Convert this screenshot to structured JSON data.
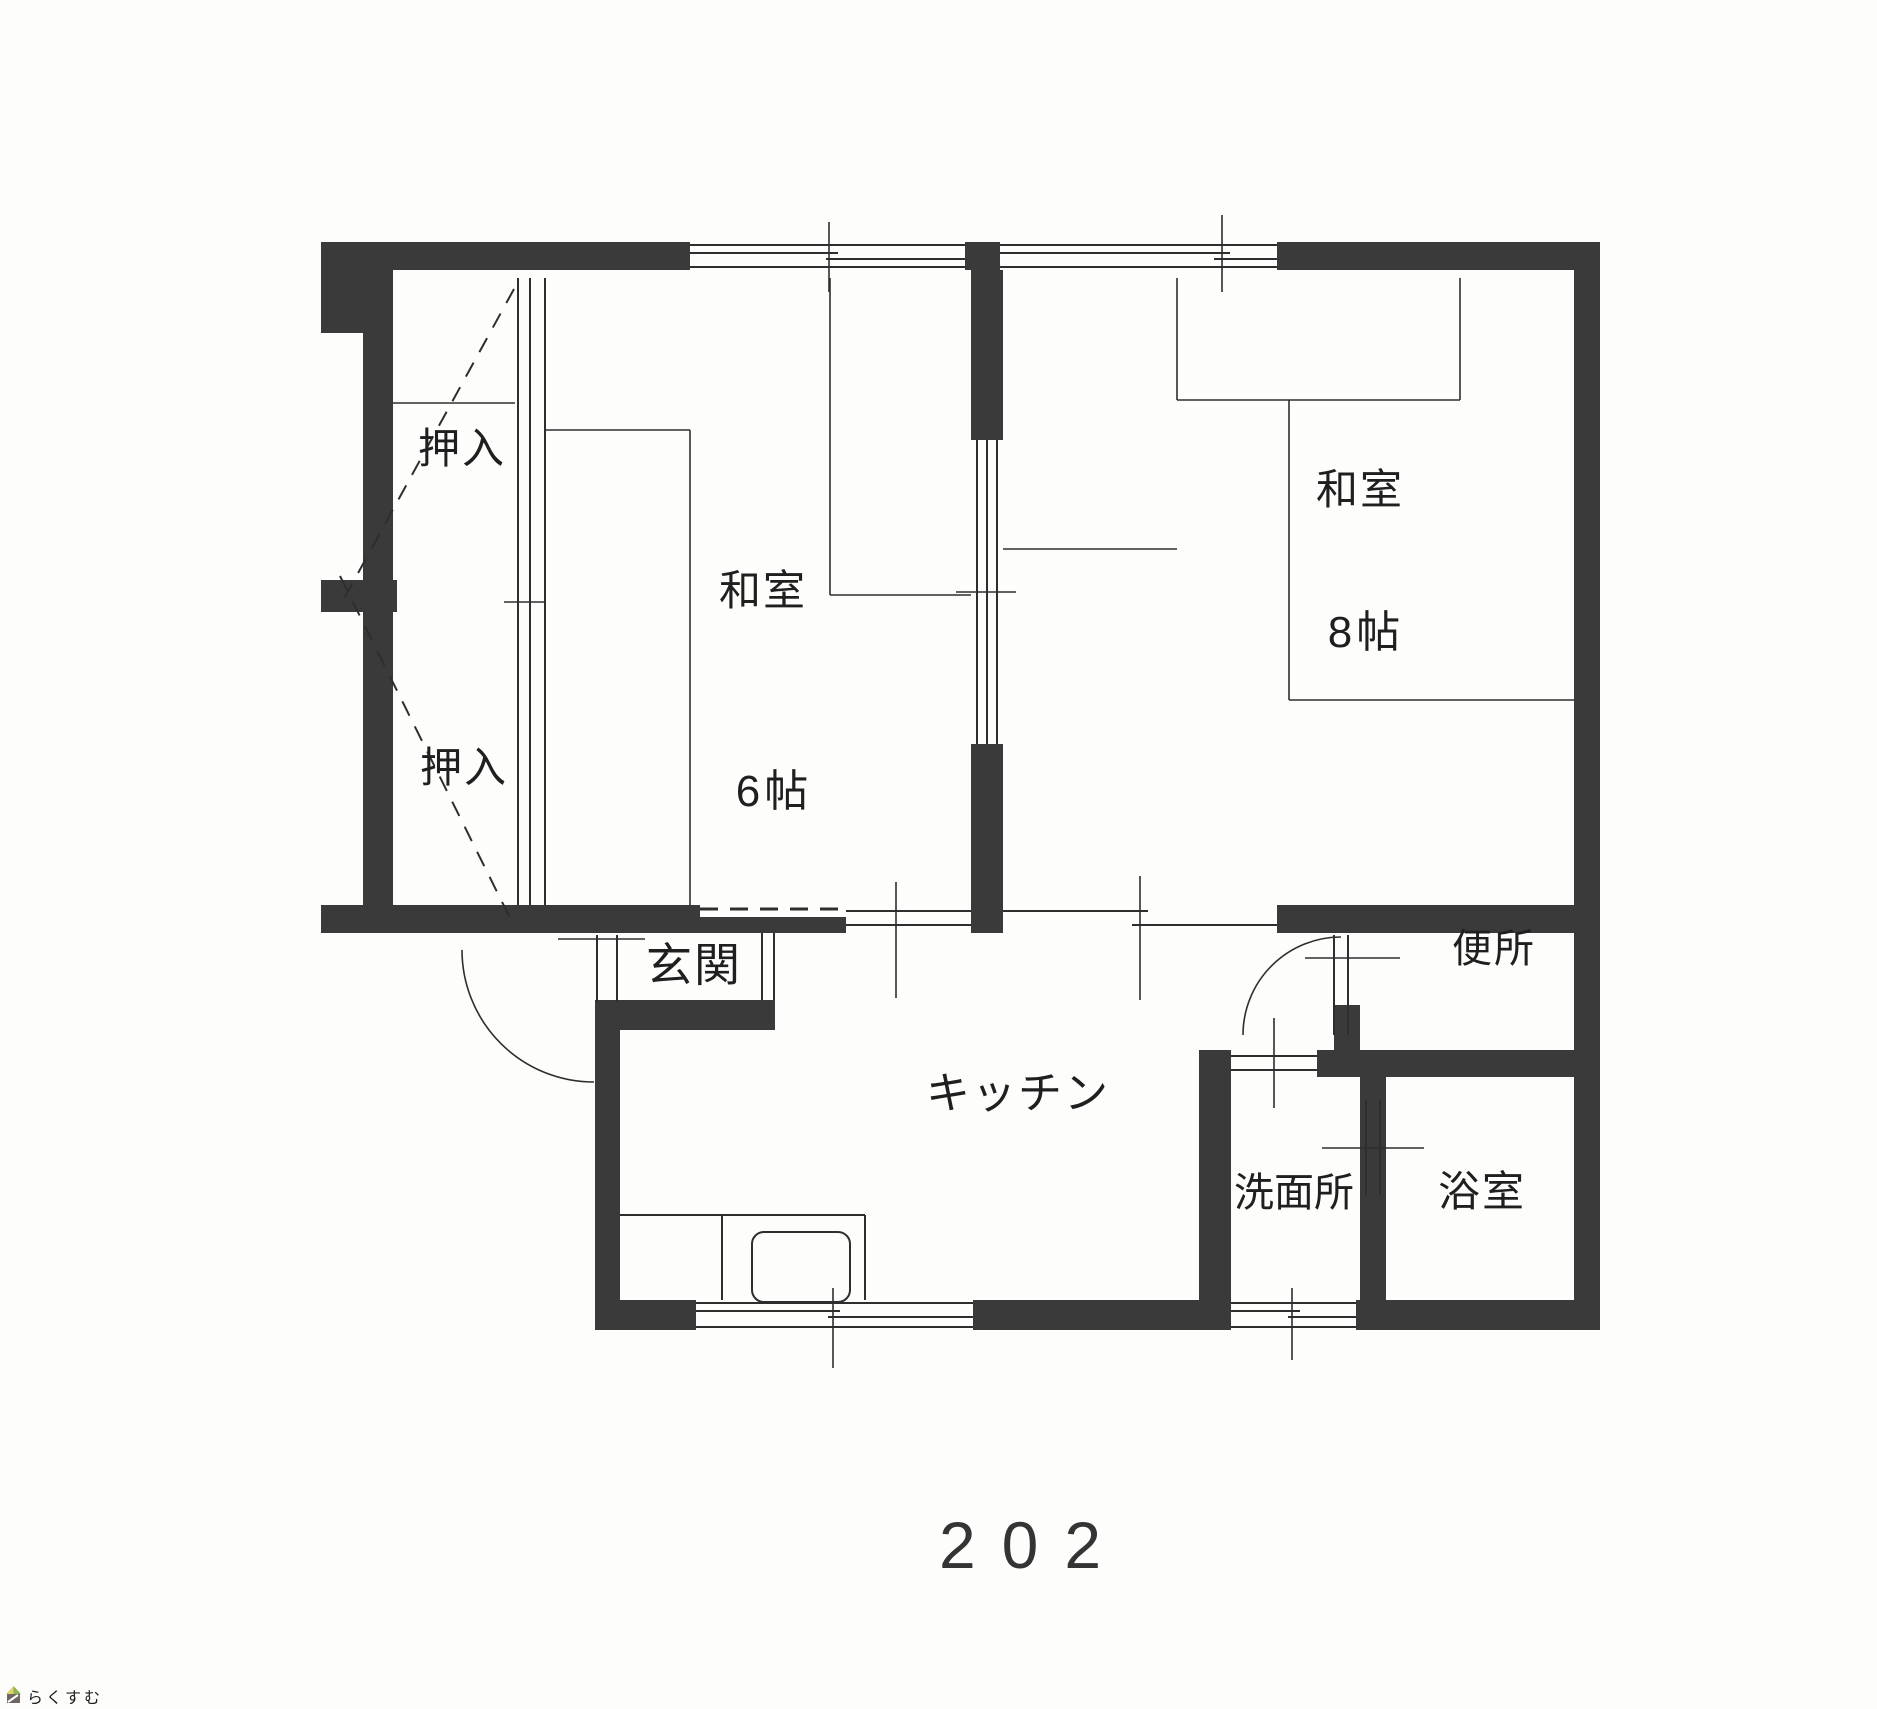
{
  "plan": {
    "unit_number": "202",
    "wall_color": "#3a3a3a",
    "line_color": "#2e2e2e",
    "rooms": {
      "closet_top": {
        "label": "押入"
      },
      "closet_bottom": {
        "label": "押入"
      },
      "washitsu6": {
        "label": "和室",
        "size": "6帖"
      },
      "washitsu8": {
        "label": "和室",
        "size": "8帖"
      },
      "genkan": {
        "label": "玄関"
      },
      "kitchen": {
        "label": "キッチン"
      },
      "toilet": {
        "label": "便所"
      },
      "washroom": {
        "label": "洗面所"
      },
      "bathroom": {
        "label": "浴室"
      }
    }
  },
  "watermark": {
    "text": "らくすむ",
    "text_color": "#a59a92",
    "roof_left_color": "#d9d46b",
    "roof_right_color": "#8fb054",
    "body_color": "#6e6660"
  }
}
